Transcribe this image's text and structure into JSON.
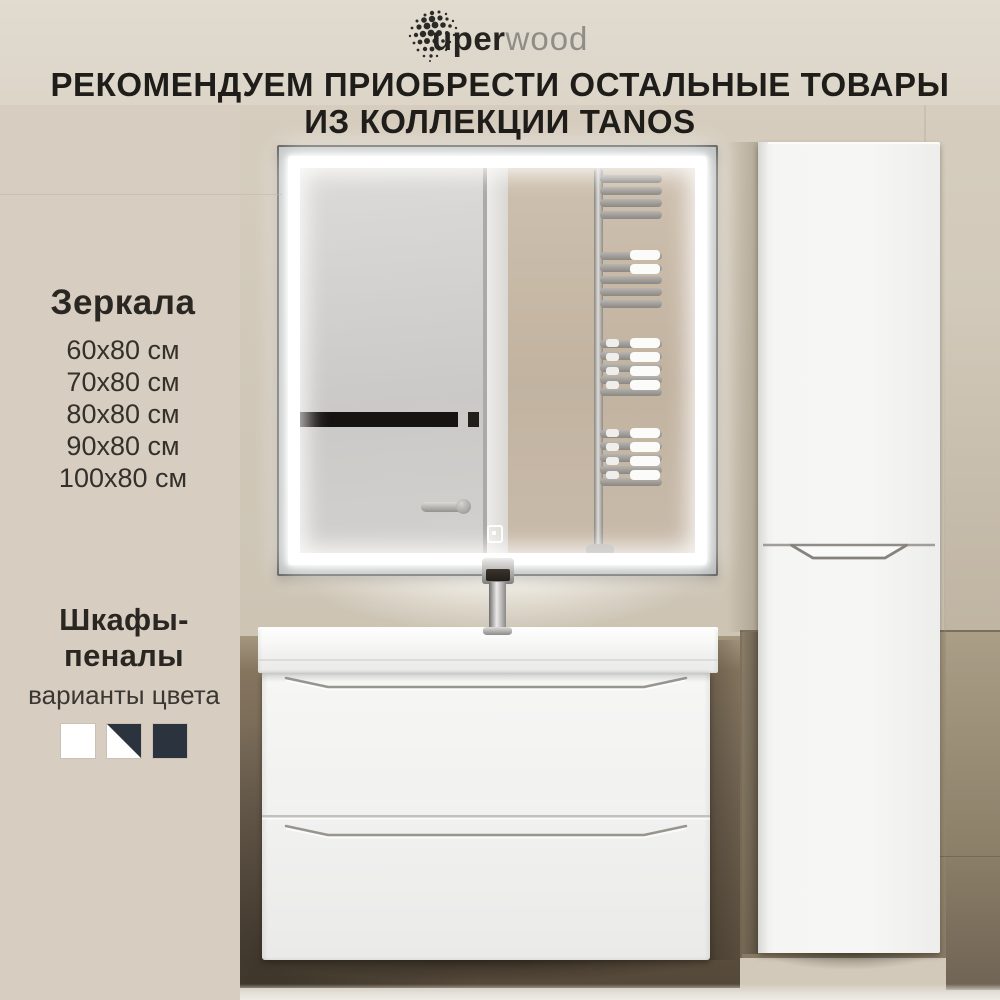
{
  "brand": {
    "name": "uperwood",
    "logo_bold": "uper",
    "logo_light": "wood"
  },
  "heading": {
    "line1": "РЕКОМЕНДУЕМ ПРИОБРЕСТИ ОСТАЛЬНЫЕ ТОВАРЫ",
    "line2": "ИЗ КОЛЛЕКЦИИ TANOS"
  },
  "mirrors": {
    "title": "Зеркала",
    "sizes": [
      "60х80 см",
      "70х80 см",
      "80х80 см",
      "90х80 см",
      "100х80 см"
    ]
  },
  "cabinets": {
    "title": "Шкафы-пеналы",
    "subtitle": "варианты цвета",
    "color_options": [
      {
        "name": "white",
        "swatch": "solid",
        "hex": "#ffffff"
      },
      {
        "name": "white-dark-split",
        "swatch": "diagonal-split",
        "hex": "#ffffff,#2a333e"
      },
      {
        "name": "dark",
        "swatch": "solid",
        "hex": "#2a333e"
      }
    ]
  },
  "colors": {
    "wall_beige": "#d2c9ba",
    "wall_top_band": "#ded7cb",
    "wall_dark_brown": "#5d5144",
    "left_panel": "#d7cec1",
    "text": "#1f1d1a",
    "logo_gray": "#8f8d87",
    "led_white": "#ffffff",
    "furniture_white": "#f4f4f3",
    "swatch_dark": "#2a333e"
  }
}
